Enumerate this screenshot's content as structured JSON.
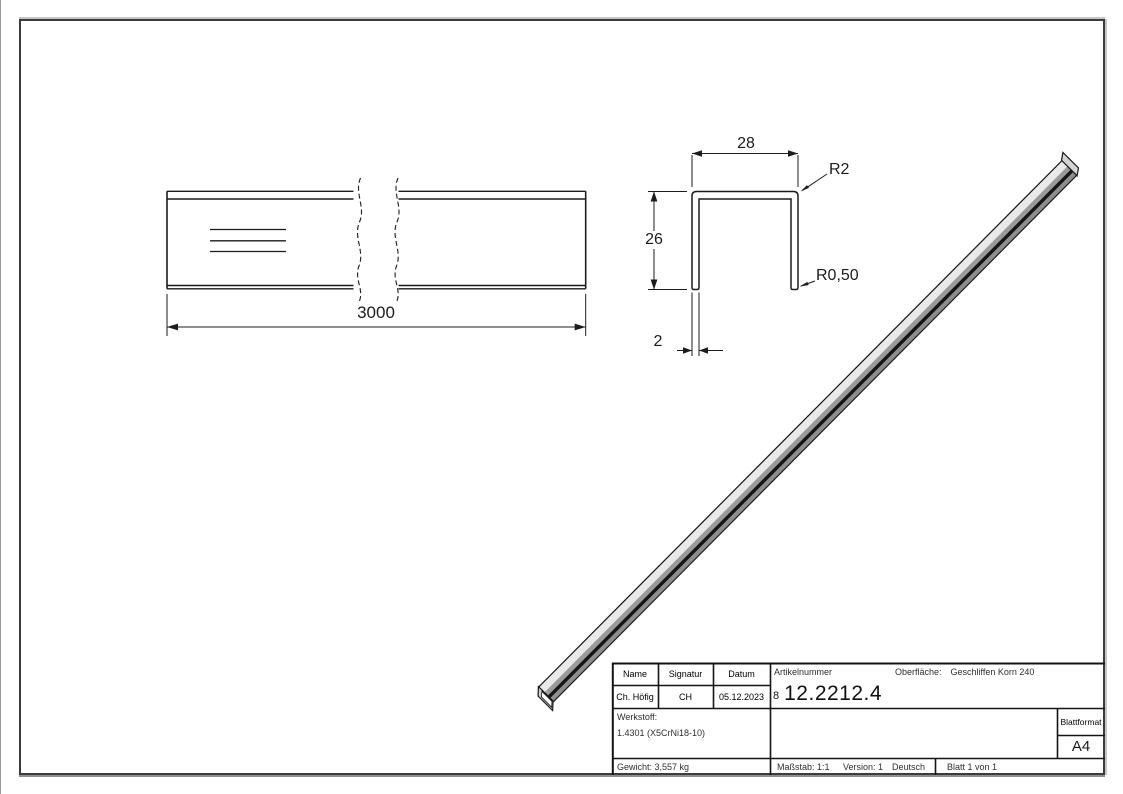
{
  "drawing": {
    "side_view": {
      "length": "3000"
    },
    "section_view": {
      "width": "28",
      "height": "26",
      "thickness": "2",
      "corner_radius": "R2",
      "edge_radius": "R0,50"
    }
  },
  "title_block": {
    "name_header": "Name",
    "signature_header": "Signatur",
    "date_header": "Datum",
    "name": "Ch. Höfig",
    "signature": "CH",
    "date": "05.12.2023",
    "article_number_label": "Artikelnummer",
    "article_number_prefix": "8",
    "article_number": "12.2212.4",
    "surface_label": "Oberfläche:",
    "surface_value": "Geschliffen Korn 240",
    "material_label": "Werkstoff:",
    "material_value": "1.4301 (X5CrNi18-10)",
    "weight": "Gewicht: 3,557 kg",
    "scale": "Maßstab: 1:1",
    "version": "Version: 1",
    "language": "Deutsch",
    "sheet": "Blatt 1 von 1",
    "sheet_format_label": "Blattformat",
    "sheet_format": "A4"
  },
  "colors": {
    "line": "#1c1c1c",
    "bar_light": "#e9e9e9",
    "bar_mid": "#9a9a9a",
    "bar_dark": "#8d8d8d",
    "frame": "#3c3c3c"
  }
}
